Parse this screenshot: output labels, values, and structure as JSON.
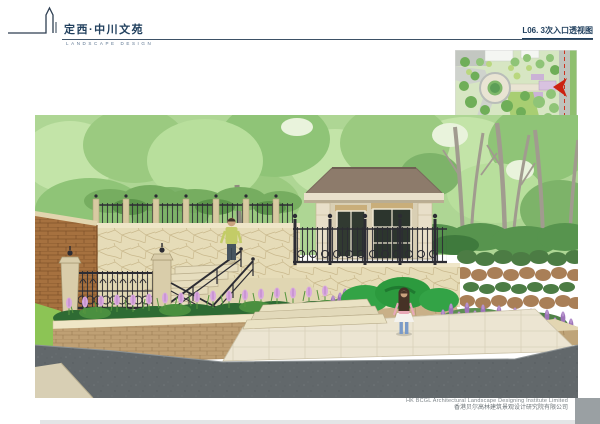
{
  "header": {
    "project_title": "定西·中川文苑",
    "project_subtitle": "LANDSCAPE DESIGN",
    "sheet_title": "L06. 3次入口透视图"
  },
  "footer": {
    "company_en": "HK BCGL Architectural Landscape Designing Institute Limited",
    "company_cn": "香港贝尔高林建筑景观设计研究院有限公司"
  },
  "palette": {
    "title_navy": "#21405e",
    "rule_color": "#3d5166",
    "footer_gray": "#7e8589",
    "foliage_light": "#aed694",
    "foliage_dark": "#6aa557",
    "stone_beige": "#e6dcb8",
    "brick_brown": "#a6713f",
    "iron_dark": "#2c2c33",
    "flower_pink": "#d9a9de",
    "flower_purple": "#9d74b8",
    "shrub_bright": "#33a346",
    "plaza_cream": "#ece5d2",
    "road_gray": "#62686b",
    "map_arrow_red": "#cc2211"
  }
}
